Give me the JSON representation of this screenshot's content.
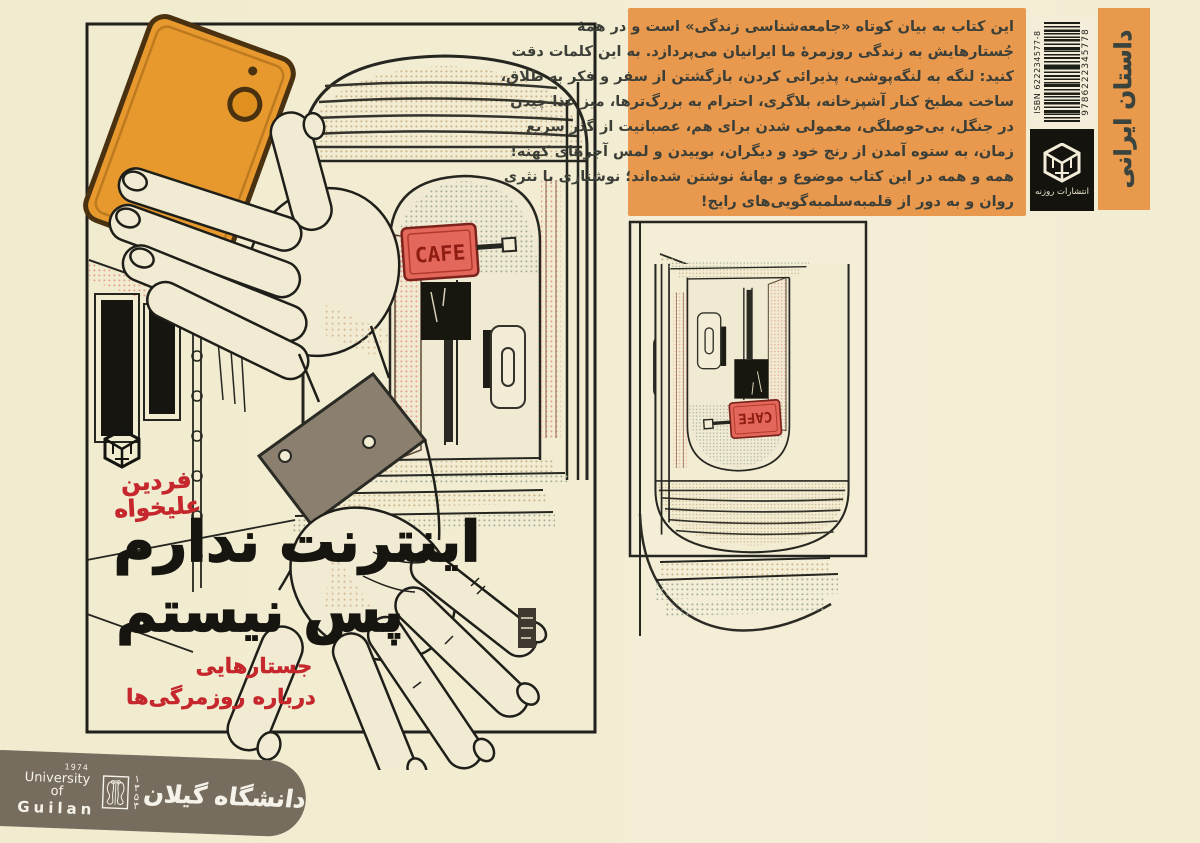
{
  "page": {
    "bg_color": "#f2ecd2"
  },
  "artwork": {
    "cafe_sign": "CAFE"
  },
  "front_cover": {
    "author_line1": "فردین",
    "author_line2": "علیخواه",
    "title_line1": "اینترنت ندارم",
    "title_line2": "پس نیستم",
    "subtitle_line1": "جستارهایی",
    "subtitle_line2": "درباره روزمرگی‌ها",
    "colors": {
      "title": "#17150f",
      "accent_red": "#c5272d",
      "phone_orange": "#e8992e",
      "wristband_gray": "#8b8070"
    }
  },
  "back_cover": {
    "description_lines": [
      "این کتاب به بیان کوتاه «جامعه‌شناسی زندگی» است و در همۀ",
      "جُستارهایش به زندگی روزمرۀ ما ایرانیان می‌پردازد. به این کلمات دقت",
      "کنید: لنگه به لنگه‌پوشی، پذیرائی کردن، بازگشتن از سفر و فکر به طلاق،",
      "ساخت مطبخ کنار آشپزخانه، بلاگری، احترام به بزرگ‌ترها، میز غذا چیدن",
      "در جنگل، بی‌حوصلگی، معمولی شدن برای هم، عصبانیت از گذر سریع",
      "زمان، به ستوه آمدن از رنج خود و دیگران، بوییدن و لمس آجرهای کهنه!",
      "همه و همه در این کتاب موضوع و بهانۀ نوشتن شده‌اند؛ نوشتاری با نثری",
      "روان و به دور از قلمبه‌سلمبه‌گویی‌های رایج!"
    ],
    "isbn_label": "ISBN 622234577-8",
    "isbn_number": "9786222345778",
    "publisher_name": "انتشارات روزنه",
    "category_label": "داستان ایرانی",
    "box_color": "#e8994e"
  },
  "footer_logo": {
    "year_en": "1974",
    "line1_en": "University of",
    "line2_en": "Guilan",
    "year_fa": "۱۳۵۳",
    "name_fa": "دانشگاه گیلان",
    "bg_color": "#766d5f"
  }
}
